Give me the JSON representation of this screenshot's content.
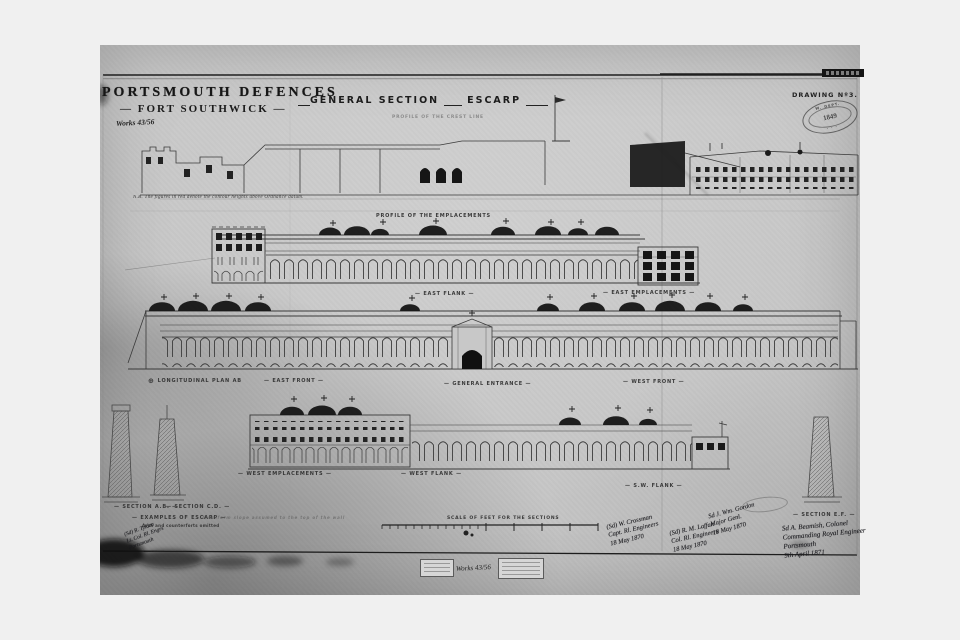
{
  "header": {
    "title": "PORTSMOUTH DEFENCES",
    "subtitle": "— FORT SOUTHWICK —",
    "ref_note": "Works 43/56",
    "heading": "GENERAL SECTION",
    "heading2": "ESCARP",
    "drawing_no": "DRAWING Nº3.",
    "stamp": {
      "top": "W. DEPT.",
      "number": "1849",
      "bottom": "· · ·"
    }
  },
  "notes": {
    "crest": "PROFILE OF THE CREST LINE",
    "nb": "N.B. The figures in red denote the contour heights above Ordnance datum."
  },
  "labels": {
    "emplacements_profile": "PROFILE OF THE EMPLACEMENTS",
    "east_flank": "— EAST FLANK —",
    "east_emplacements": "— EAST EMPLACEMENTS —",
    "longitudinal_plan": "LONGITUDINAL PLAN AB",
    "east_front": "— EAST FRONT —",
    "general_entrance": "— GENERAL ENTRANCE —",
    "west_front": "— WEST FRONT —",
    "west_emplacements": "— WEST EMPLACEMENTS —",
    "west_flank": "— WEST FLANK —",
    "sw_flank": "— S.W. FLANK —",
    "section_ab": "— SECTION A.B. —",
    "section_cd": "— SECTION C.D. —",
    "section_ef": "— SECTION E.F. —",
    "examples": "— EXAMPLES OF ESCARP —",
    "examples_sub": "Arch and counterforts omitted",
    "examples_note": "A uniform slope assumed to the top of the wall",
    "scale": "SCALE OF FEET FOR THE SECTIONS"
  },
  "signatures": [
    {
      "lines": [
        "(Sd) W. Crossman",
        "Capt. Rl. Engineers",
        "18 May 1870"
      ]
    },
    {
      "lines": [
        "(Sd) R. M. Laffan",
        "Col. Rl. Engineers",
        "18 May 1870"
      ]
    },
    {
      "lines": [
        "Sd J. Wm. Gordon",
        "Major Genl.",
        "18 May 1870"
      ]
    },
    {
      "lines": [
        "Sd A. Beamish, Colonel",
        "Commanding Royal Engineer",
        "Portsmouth",
        "9th April 1871"
      ]
    }
  ],
  "handnotes": {
    "bottom_left_1": "(Sd) R. Tylden",
    "bottom_left_2": "Lt. Col. Rl. Engrs",
    "bottom_left_3": "Portsmouth",
    "footer_ref": "Works 43/56"
  }
}
